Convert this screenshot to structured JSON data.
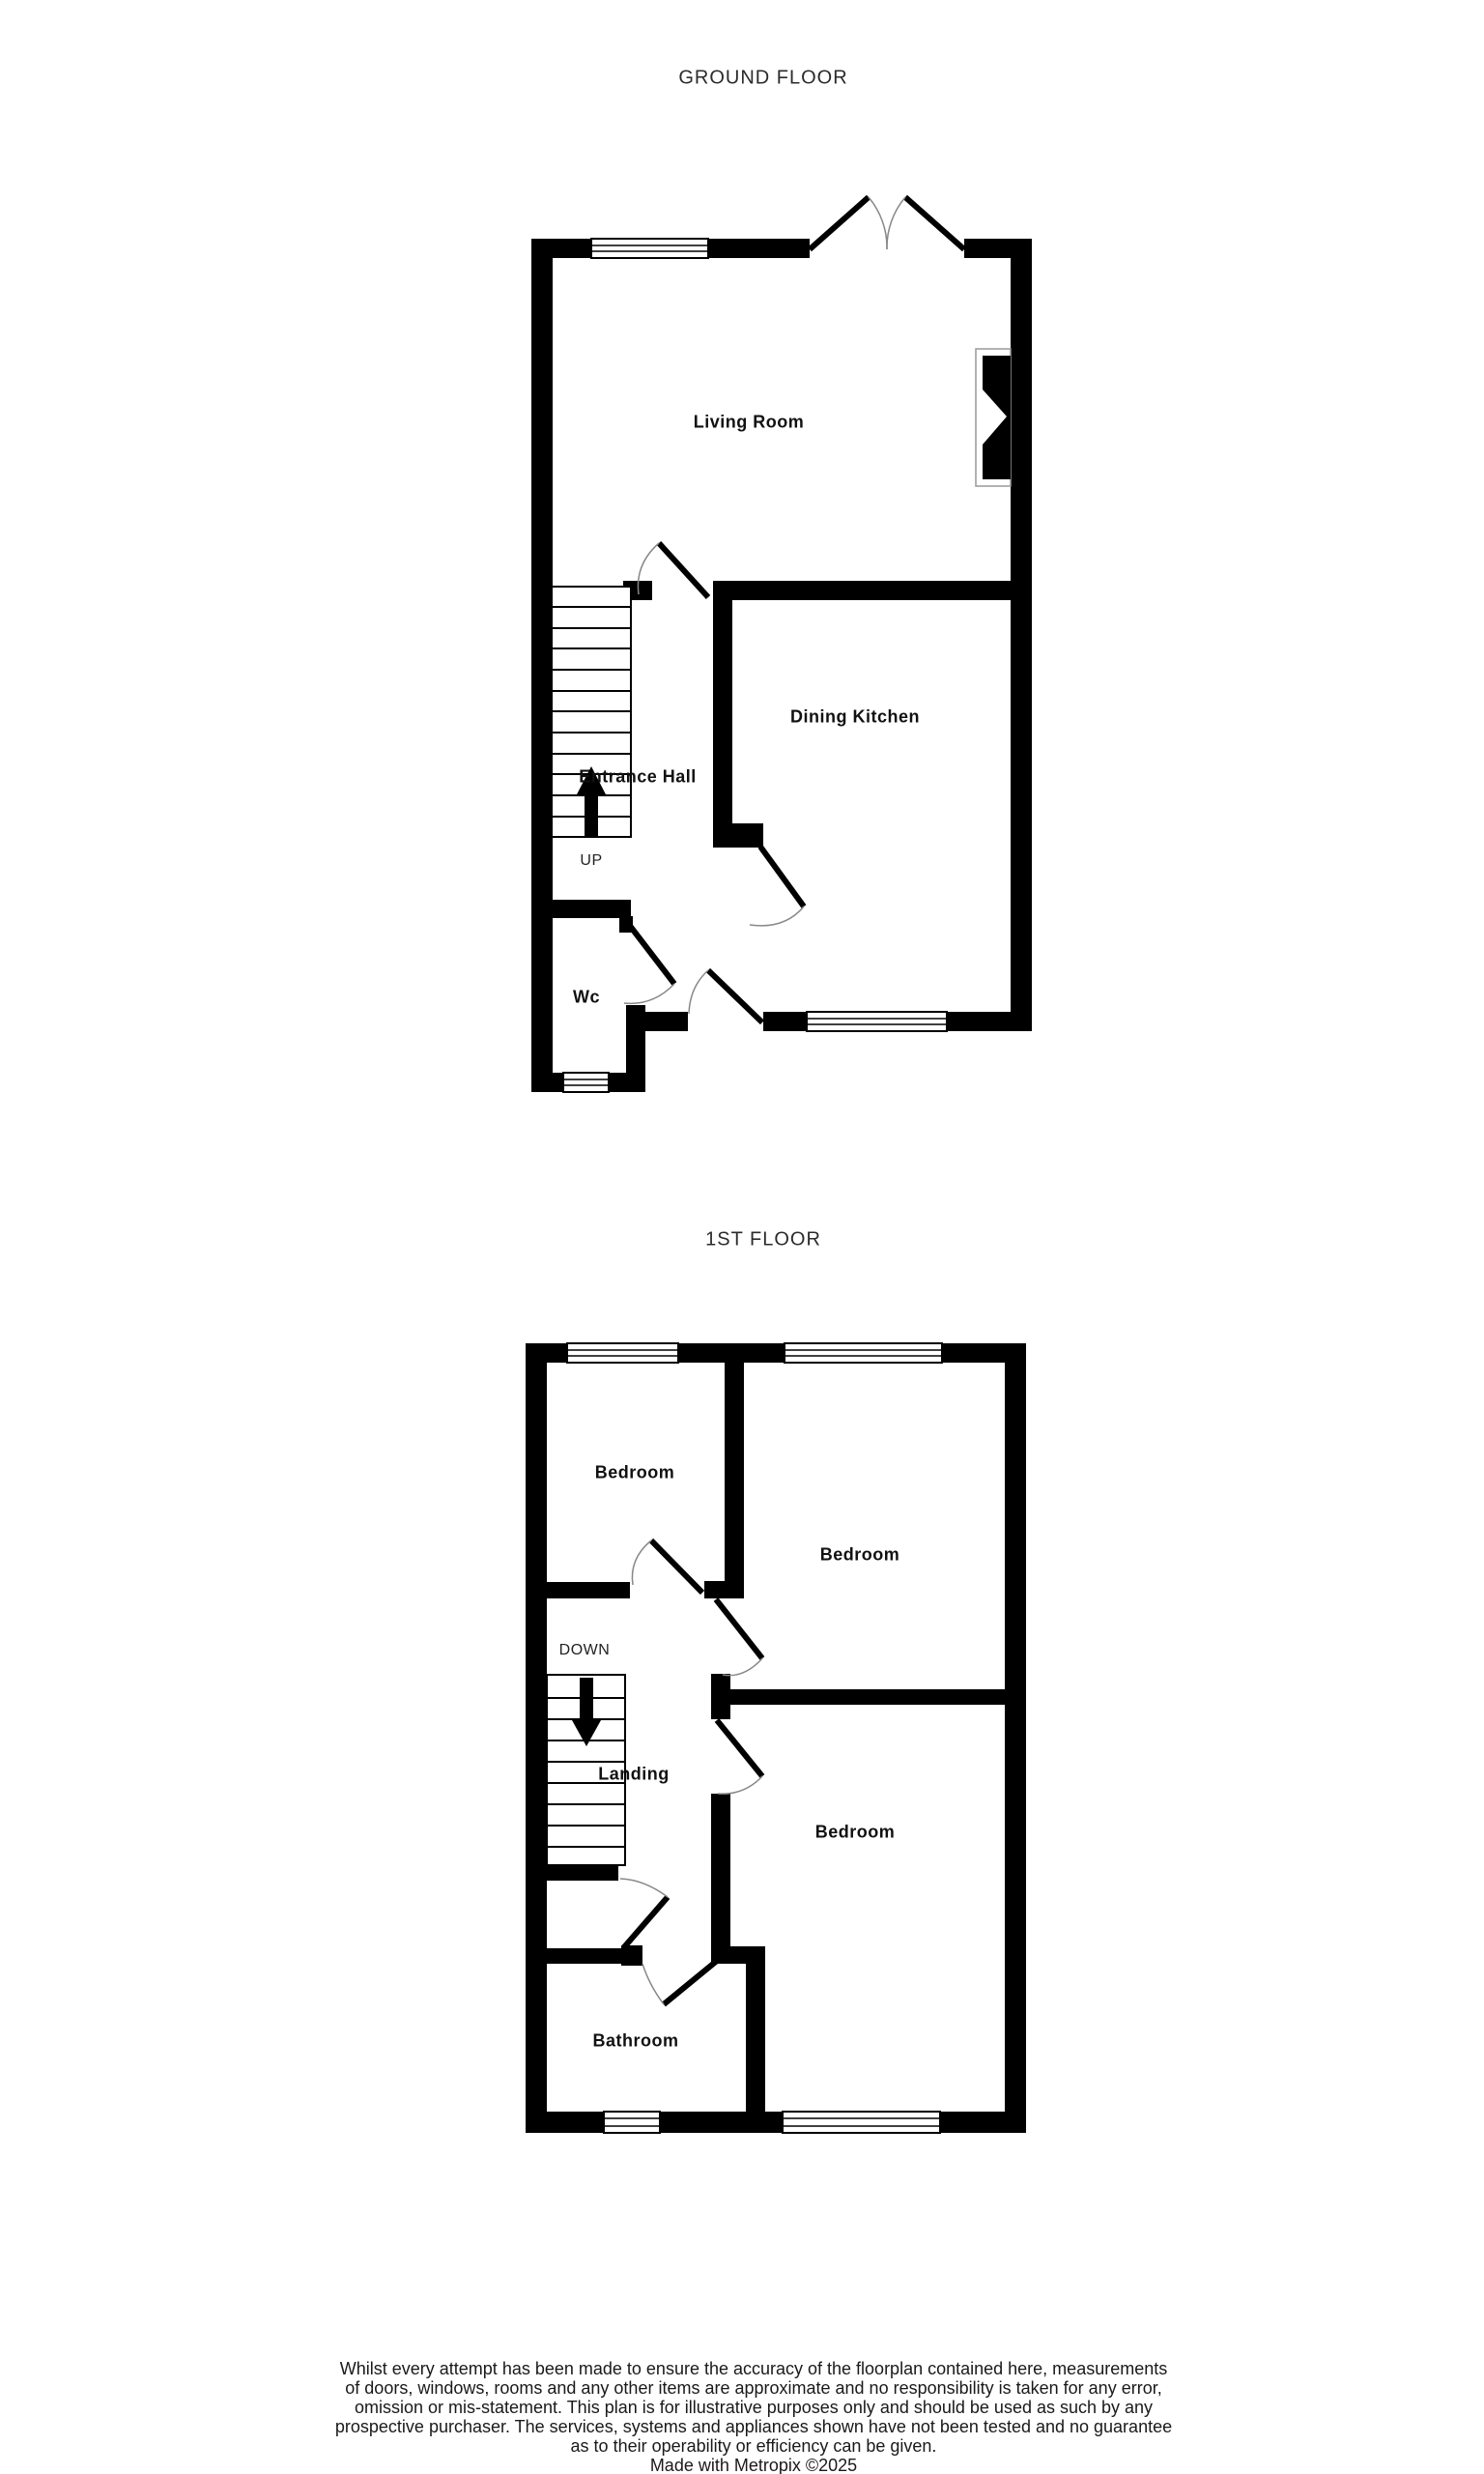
{
  "colors": {
    "wall": "#000000",
    "text": "#1a1a1a",
    "door_arc": "#888888",
    "background": "#ffffff"
  },
  "ground_floor": {
    "title": "GROUND FLOOR",
    "rooms": {
      "living_room": "Living Room",
      "dining_kitchen": "Dining Kitchen",
      "entrance_hall": "Entrance Hall",
      "wc": "Wc"
    },
    "stairs_label": "UP"
  },
  "first_floor": {
    "title": "1ST FLOOR",
    "rooms": {
      "bedroom_front_left": "Bedroom",
      "bedroom_front_right": "Bedroom",
      "bedroom_back": "Bedroom",
      "landing": "Landing",
      "bathroom": "Bathroom"
    },
    "stairs_label": "DOWN"
  },
  "disclaimer": {
    "line1": "Whilst every attempt has been made to ensure the accuracy of the floorplan contained here, measurements",
    "line2": "of doors, windows, rooms and any other items are approximate and no responsibility is taken for any error,",
    "line3": "omission or mis-statement. This plan is for illustrative purposes only and should be used as such by any",
    "line4": "prospective purchaser. The services, systems and appliances shown have not been tested and no guarantee",
    "line5": "as to their operability or efficiency can be given.",
    "credit": "Made with Metropix ©2025"
  }
}
